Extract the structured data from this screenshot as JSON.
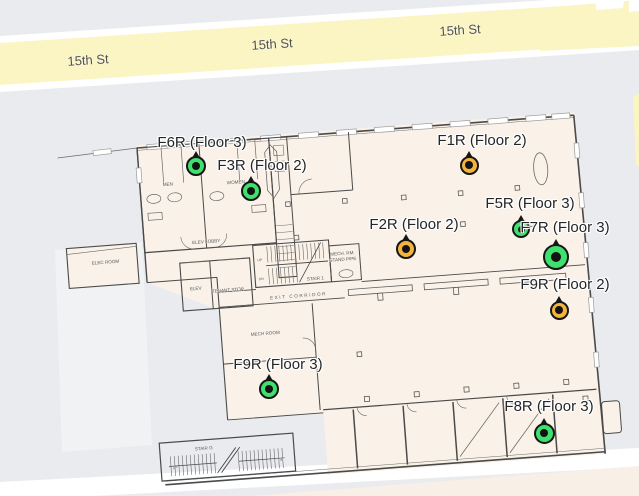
{
  "map": {
    "street": {
      "name": "15th St"
    },
    "street_labels": [
      {
        "text": "15th St",
        "x": 88,
        "y": 60
      },
      {
        "text": "15th St",
        "x": 272,
        "y": 44
      },
      {
        "text": "15th St",
        "x": 460,
        "y": 30
      }
    ],
    "colors": {
      "background": "#e9ebee",
      "road_fill": "#fbf5c3",
      "road_casing": "#ffffff",
      "building_fill": "#faf2e8",
      "marker_green": "#3ee06e",
      "marker_orange": "#f2b43c",
      "marker_ring": "#161616"
    }
  },
  "markers": [
    {
      "id": "F6R",
      "label": "F6R (Floor 3)",
      "status": "green",
      "x": 196,
      "y": 166,
      "size": 20,
      "label_x": 202,
      "label_y": 134
    },
    {
      "id": "F3R",
      "label": "F3R (Floor 2)",
      "status": "green",
      "x": 251,
      "y": 191,
      "size": 20,
      "label_x": 262,
      "label_y": 157
    },
    {
      "id": "F1R",
      "label": "F1R (Floor 2)",
      "status": "orange",
      "x": 469,
      "y": 165,
      "size": 19,
      "label_x": 482,
      "label_y": 132
    },
    {
      "id": "F2R",
      "label": "F2R (Floor 2)",
      "status": "orange",
      "x": 406,
      "y": 249,
      "size": 20,
      "label_x": 414,
      "label_y": 216
    },
    {
      "id": "F5R",
      "label": "F5R (Floor 3)",
      "status": "green",
      "x": 521,
      "y": 229,
      "size": 18,
      "label_x": 530,
      "label_y": 195
    },
    {
      "id": "F7R",
      "label": "F7R (Floor 3)",
      "status": "green",
      "x": 556,
      "y": 257,
      "size": 26,
      "label_x": 565,
      "label_y": 219
    },
    {
      "id": "F9R-2",
      "label": "F9R (Floor 2)",
      "status": "orange",
      "x": 559,
      "y": 310,
      "size": 19,
      "label_x": 565,
      "label_y": 276
    },
    {
      "id": "F9R-3",
      "label": "F9R (Floor 3)",
      "status": "green",
      "x": 269,
      "y": 389,
      "size": 20,
      "label_x": 278,
      "label_y": 356
    },
    {
      "id": "F8R",
      "label": "F8R (Floor 3)",
      "status": "green",
      "x": 544,
      "y": 433,
      "size": 21,
      "label_x": 549,
      "label_y": 398
    }
  ],
  "floorplan": {
    "room_labels": [
      {
        "text": "MEN",
        "x": 28,
        "y": 40
      },
      {
        "text": "WOMEN",
        "x": 96,
        "y": 43
      },
      {
        "text": "ELEC ROOM",
        "x": -40,
        "y": 113
      },
      {
        "text": "ELEV LOBBY",
        "x": 62,
        "y": 100
      },
      {
        "text": "ELEV",
        "x": 48,
        "y": 146
      },
      {
        "text": "TENANT STOR",
        "x": 80,
        "y": 150
      },
      {
        "text": "UP",
        "x": 114,
        "y": 122,
        "fs": 3.4
      },
      {
        "text": "DN",
        "x": 114,
        "y": 141,
        "fs": 3.4
      },
      {
        "text": "STAIR 1",
        "x": 168,
        "y": 145
      },
      {
        "text": "MECH. RM.",
        "x": 197,
        "y": 122
      },
      {
        "text": "STAND PIPE",
        "x": 197,
        "y": 128
      },
      {
        "text": "EXIT CORRIDOR",
        "x": 150,
        "y": 161,
        "ls": 1.6
      },
      {
        "text": "MECH ROOM",
        "x": 114,
        "y": 196
      },
      {
        "text": "STAIR G",
        "x": 44,
        "y": 306
      },
      {
        "text": "UP",
        "x": 14,
        "y": 323,
        "fs": 3.4
      },
      {
        "text": "DN",
        "x": 120,
        "y": 323,
        "fs": 3.4
      }
    ]
  }
}
